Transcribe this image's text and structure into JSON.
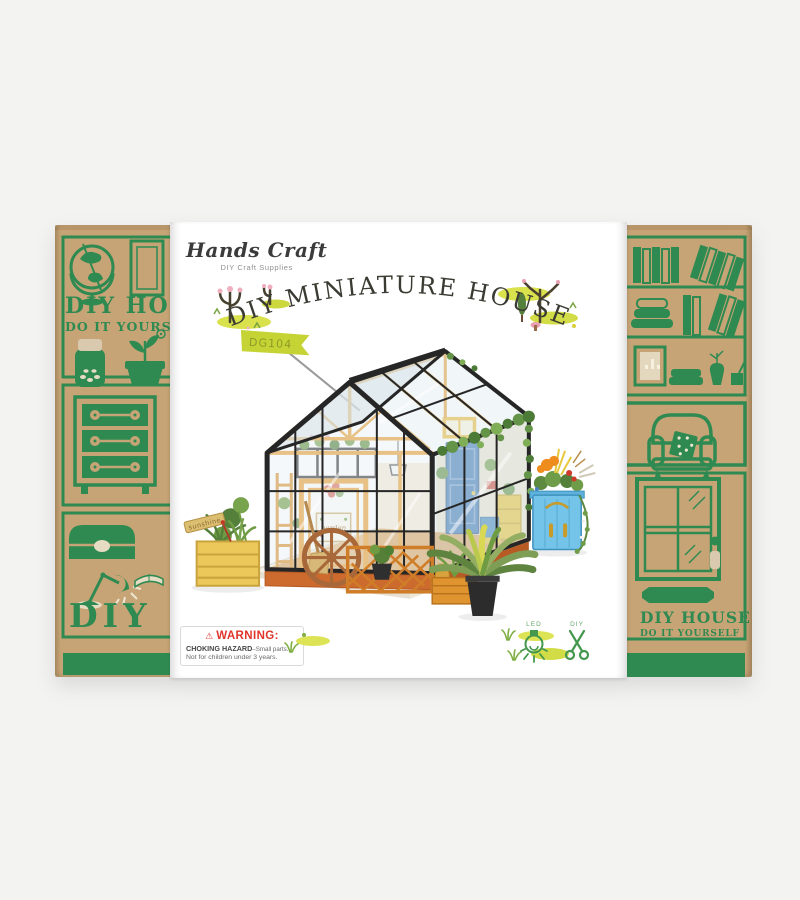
{
  "colors": {
    "background": "#f3f3f2",
    "kraft": "#c6a476",
    "print_green": "#2f8a52",
    "sleeve_white": "#ffffff",
    "warning_red": "#e0352b",
    "flag_green": "#c5d334",
    "icon_green": "#44984e",
    "frame_black": "#262626",
    "wood_orange": "#e59b2b",
    "door_blue": "#3a76b5",
    "cabinet_blue": "#74c3e8"
  },
  "brand": {
    "name": "Hands Craft",
    "tagline": "DIY Craft Supplies"
  },
  "sleeve": {
    "title": "DIY MINIATURE HOUSE",
    "product_name": "CATHY'S FLOWER HOUSE",
    "size_metric": "Assembled Size: 195*175*175mm",
    "size_imperial": "7.7*6.9*6.9(H)in"
  },
  "warning": {
    "symbol": "⚠",
    "heading": "WARNING:",
    "hazard": "CHOKING HAZARD",
    "hazard_detail": "–Small parts.",
    "note": "Not for children under 3 years."
  },
  "features": {
    "led_label": "LED",
    "diy_label": "DIY"
  },
  "photo_labels": {
    "flag": "DG104",
    "sunshine_sign": "sunshine",
    "garden_sign": "garden"
  },
  "flaps": {
    "diy_house": "DIY HOUSE",
    "do_it_yourself": "DO IT YOURSELF",
    "diy": "DIY"
  }
}
